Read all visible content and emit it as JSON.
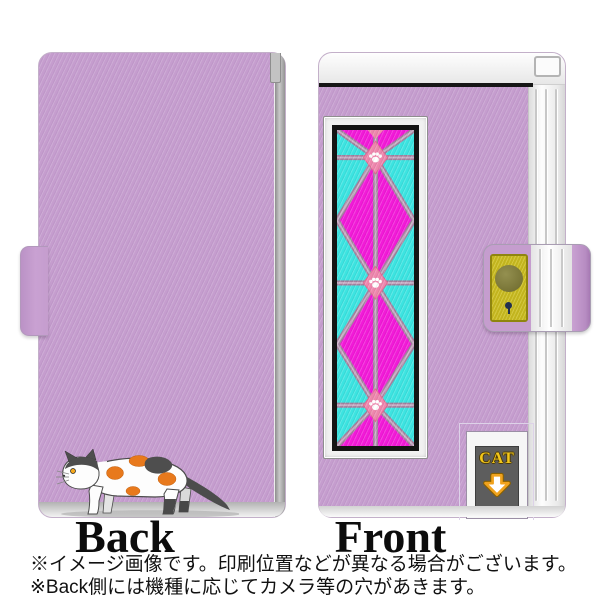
{
  "image": {
    "back_label": "Back",
    "front_label": "Front",
    "cat_window_text": "CAT",
    "notes": [
      "※イメージ画像です。印刷位置などが異なる場合がございます。",
      "※Back側には機種に応じてカメラ等の穴があきます。"
    ]
  },
  "icons": {
    "paw_print": "paw-print-icon",
    "down_arrow": "down-arrow-icon",
    "clasp_button": "clasp-button",
    "cat": "calico-cat-illustration"
  },
  "colors": {
    "case_purple": "#c59dce",
    "glass_magenta": "#f21ad8",
    "glass_cyan": "#3ce4e1",
    "lattice_mauve": "#a3819f",
    "paw_diamond_pink": "#ee86ad",
    "clasp_plate_yellow": "#ccbe20",
    "cat_text_yellow": "#f3c71b",
    "cat_door_gray": "#5d5d5d",
    "arrow_orange": "#f0a21d",
    "caption_black": "#0c0c0c"
  }
}
